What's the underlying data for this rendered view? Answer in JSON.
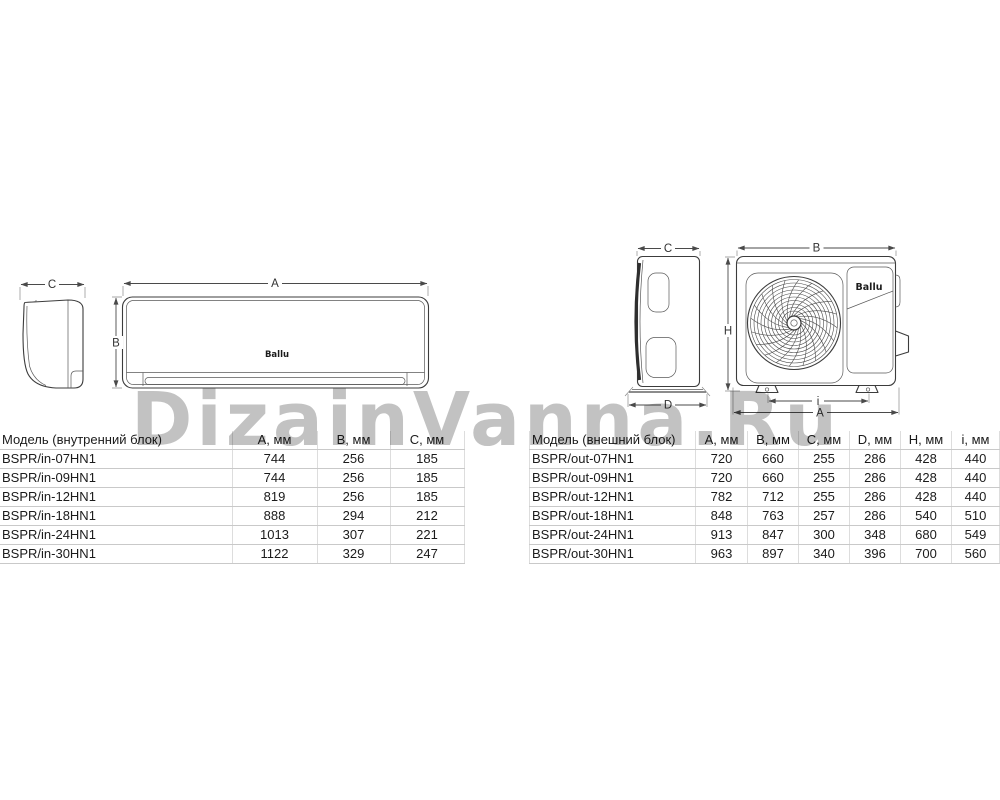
{
  "watermark": "DizainVanna.Ru",
  "brand": "Ballu",
  "dims": {
    "A": "A",
    "B": "B",
    "C": "C",
    "D": "D",
    "H": "H",
    "i": "i"
  },
  "indoor_table": {
    "headers": [
      "Модель (внутренний блок)",
      "A, мм",
      "B, мм",
      "C, мм"
    ],
    "rows": [
      [
        "BSPR/in-07HN1",
        "744",
        "256",
        "185"
      ],
      [
        "BSPR/in-09HN1",
        "744",
        "256",
        "185"
      ],
      [
        "BSPR/in-12HN1",
        "819",
        "256",
        "185"
      ],
      [
        "BSPR/in-18HN1",
        "888",
        "294",
        "212"
      ],
      [
        "BSPR/in-24HN1",
        "1013",
        "307",
        "221"
      ],
      [
        "BSPR/in-30HN1",
        "1122",
        "329",
        "247"
      ]
    ]
  },
  "outdoor_table": {
    "headers": [
      "Модель (внешний блок)",
      "A, мм",
      "B, мм",
      "C, мм",
      "D, мм",
      "H, мм",
      "i, мм"
    ],
    "rows": [
      [
        "BSPR/out-07HN1",
        "720",
        "660",
        "255",
        "286",
        "428",
        "440"
      ],
      [
        "BSPR/out-09HN1",
        "720",
        "660",
        "255",
        "286",
        "428",
        "440"
      ],
      [
        "BSPR/out-12HN1",
        "782",
        "712",
        "255",
        "286",
        "428",
        "440"
      ],
      [
        "BSPR/out-18HN1",
        "848",
        "763",
        "257",
        "286",
        "540",
        "510"
      ],
      [
        "BSPR/out-24HN1",
        "913",
        "847",
        "300",
        "348",
        "680",
        "549"
      ],
      [
        "BSPR/out-30HN1",
        "963",
        "897",
        "340",
        "396",
        "700",
        "560"
      ]
    ]
  }
}
